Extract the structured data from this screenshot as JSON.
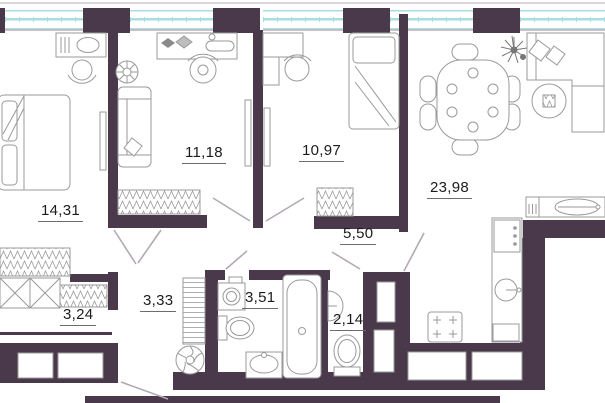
{
  "plan": {
    "type": "apartment-floor-plan",
    "rooms": [
      {
        "id": "bedroom-1",
        "area": "14,31"
      },
      {
        "id": "bedroom-2",
        "area": "11,18"
      },
      {
        "id": "bedroom-3",
        "area": "10,97"
      },
      {
        "id": "living-kitchen",
        "area": "23,98"
      },
      {
        "id": "hallway",
        "area": "5,50"
      },
      {
        "id": "corridor",
        "area": "3,33"
      },
      {
        "id": "bathroom",
        "area": "3,51"
      },
      {
        "id": "wc",
        "area": "2,14"
      },
      {
        "id": "wardrobe-room",
        "area": "3,24"
      }
    ],
    "colors": {
      "wall": "#4a394a",
      "window": "#a8dde2",
      "line": "#9a9a9a",
      "label": "#1c1c1c",
      "bg": "#ffffff"
    },
    "furniture": [
      "double-bed",
      "dressing-table",
      "stool",
      "tv-panel",
      "wardrobe-rack",
      "sofa",
      "desk",
      "office-chair",
      "plant",
      "single-bed",
      "dining-table",
      "dining-chair",
      "corner-sofa",
      "coffee-table",
      "kitchen-counter",
      "kitchen-sink",
      "stove",
      "fridge",
      "dishwasher",
      "hob",
      "washing-machine",
      "toilet",
      "wash-basin",
      "bathtub",
      "corner-basin",
      "towel-ladder",
      "exhaust-fan",
      "closet-x",
      "duct-shaft",
      "door-swing",
      "stair-window"
    ]
  }
}
